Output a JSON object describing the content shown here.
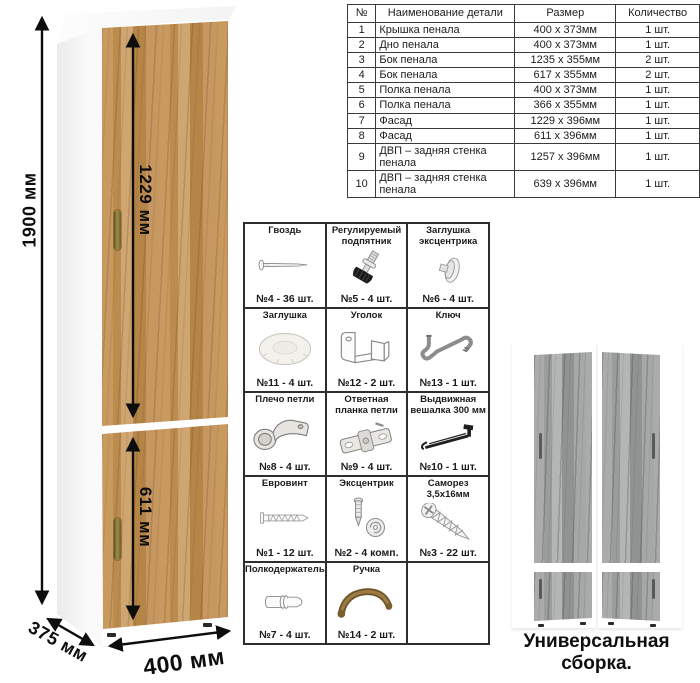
{
  "dimensions": {
    "height": "1900 мм",
    "upper_door": "1229 мм",
    "lower_door": "611 мм",
    "width": "400 мм",
    "depth": "375 мм"
  },
  "parts_table": {
    "headers": [
      "№",
      "Наименование детали",
      "Размер",
      "Количество"
    ],
    "rows": [
      [
        "1",
        "Крышка пенала",
        "400 х 373мм",
        "1 шт."
      ],
      [
        "2",
        "Дно пенала",
        "400 х 373мм",
        "1 шт."
      ],
      [
        "3",
        "Бок пенала",
        "1235 х 355мм",
        "2 шт."
      ],
      [
        "4",
        "Бок пенала",
        "617 х 355мм",
        "2 шт."
      ],
      [
        "5",
        "Полка пенала",
        "400 х 373мм",
        "1 шт."
      ],
      [
        "6",
        "Полка пенала",
        "366 х 355мм",
        "1 шт."
      ],
      [
        "7",
        "Фасад",
        "1229 х 396мм",
        "1 шт."
      ],
      [
        "8",
        "Фасад",
        "611 х 396мм",
        "1 шт."
      ],
      [
        "9",
        "ДВП – задняя стенка пенала",
        "1257 х 396мм",
        "1 шт."
      ],
      [
        "10",
        "ДВП – задняя стенка пенала",
        "639 х 396мм",
        "1 шт."
      ]
    ]
  },
  "hardware": {
    "items": [
      {
        "name": "Гвоздь",
        "qty": "№4 - 36 шт.",
        "icon": "nail-icon"
      },
      {
        "name": "Регулируемый подпятник",
        "qty": "№5 - 4 шт.",
        "icon": "adjustable-foot-icon"
      },
      {
        "name": "Заглушка эксцентрика",
        "qty": "№6 - 4 шт.",
        "icon": "cam-cover-icon"
      },
      {
        "name": "Заглушка",
        "qty": "№11 - 4 шт.",
        "icon": "cap-icon"
      },
      {
        "name": "Уголок",
        "qty": "№12 - 2 шт.",
        "icon": "corner-bracket-icon"
      },
      {
        "name": "Ключ",
        "qty": "№13 - 1 шт.",
        "icon": "key-icon"
      },
      {
        "name": "Плечо петли",
        "qty": "№8 - 4 шт.",
        "icon": "hinge-arm-icon"
      },
      {
        "name": "Ответная планка петли",
        "qty": "№9 - 4 шт.",
        "icon": "hinge-plate-icon"
      },
      {
        "name": "Выдвижная вешалка 300 мм",
        "qty": "№10 - 1 шт.",
        "icon": "pullout-hanger-icon"
      },
      {
        "name": "Евровинт",
        "qty": "№1 - 12 шт.",
        "icon": "euro-screw-icon"
      },
      {
        "name": "Эксцентрик",
        "qty": "№2 - 4 комп.",
        "icon": "cam-lock-icon"
      },
      {
        "name": "Саморез 3,5х16мм",
        "qty": "№3 - 22 шт.",
        "icon": "self-tapping-screw-icon"
      },
      {
        "name": "Полкодержатель",
        "qty": "№7 - 4 шт.",
        "icon": "shelf-pin-icon"
      },
      {
        "name": "Ручка",
        "qty": "№14 - 2 шт.",
        "icon": "handle-icon"
      },
      {
        "name": "",
        "qty": "",
        "icon": ""
      }
    ]
  },
  "caption": "Универсальная сборка.",
  "colors": {
    "wood": "#c1945a",
    "gray_wood": "#a5a7a6",
    "brass_handle": "#8a7a3f",
    "arrow": "#111111",
    "table_border": "#3b3b3b"
  }
}
